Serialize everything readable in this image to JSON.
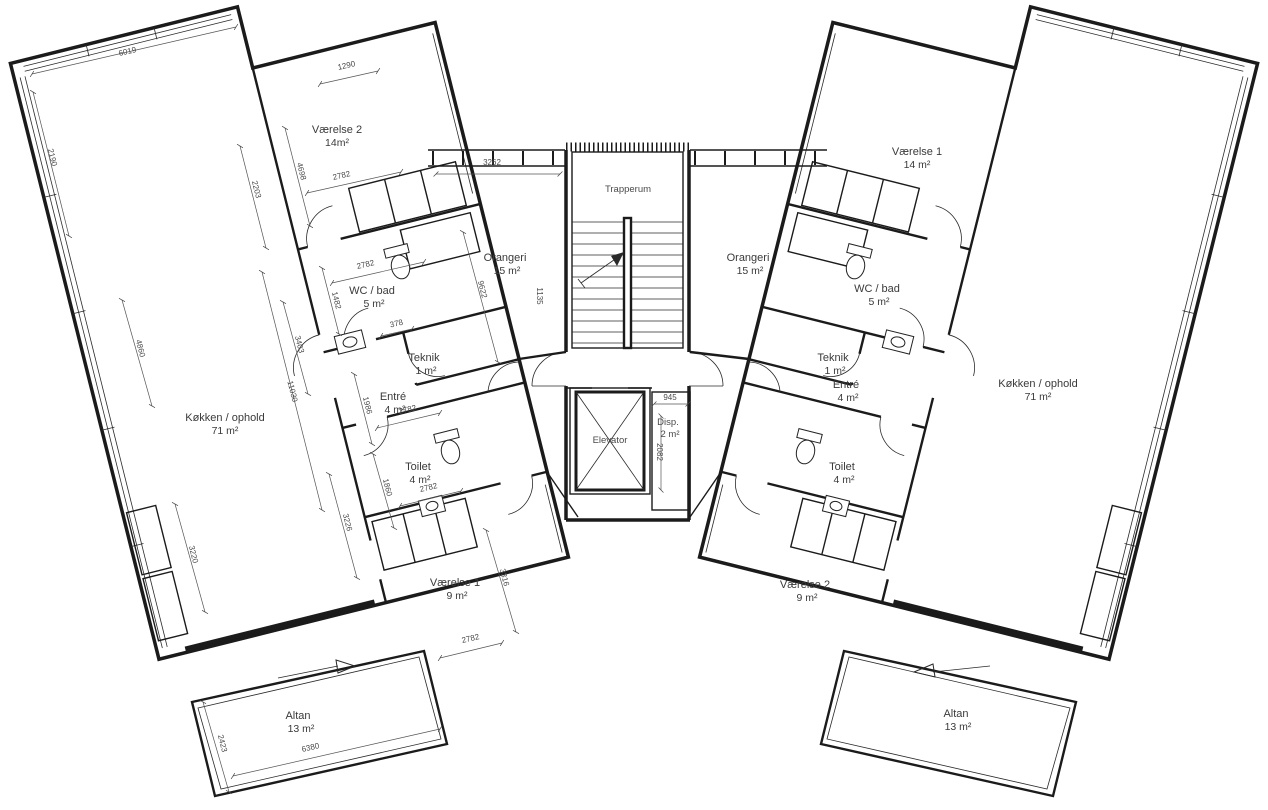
{
  "plan": {
    "core": {
      "stair": {
        "name": "Trapperum"
      },
      "elevator": {
        "name": "Elevator"
      },
      "disp": {
        "name": "Disp.",
        "area": "2 m²"
      }
    },
    "left": {
      "vaerelse2": {
        "name": "Værelse 2",
        "area": "14m²"
      },
      "wcbad": {
        "name": "WC / bad",
        "area": "5 m²"
      },
      "teknik": {
        "name": "Teknik",
        "area": "1 m²"
      },
      "entre": {
        "name": "Entré",
        "area": "4 m²"
      },
      "toilet": {
        "name": "Toilet",
        "area": "4 m²"
      },
      "kokken": {
        "name": "Køkken / ophold",
        "area": "71 m²"
      },
      "vaerelse1": {
        "name": "Værelse 1",
        "area": "9 m²"
      },
      "orangeri": {
        "name": "Orangeri",
        "area": "15 m²"
      },
      "altan": {
        "name": "Altan",
        "area": "13 m²"
      }
    },
    "right": {
      "vaerelse1": {
        "name": "Værelse 1",
        "area": "14 m²"
      },
      "wcbad": {
        "name": "WC / bad",
        "area": "5 m²"
      },
      "teknik": {
        "name": "Teknik",
        "area": "1 m²"
      },
      "entre": {
        "name": "Entré",
        "area": "4 m²"
      },
      "toilet": {
        "name": "Toilet",
        "area": "4 m²"
      },
      "orangeri": {
        "name": "Orangeri",
        "area": "15 m²"
      },
      "kokken": {
        "name": "Køkken / ophold",
        "area": "71 m²"
      },
      "vaerelse2": {
        "name": "Værelse 2",
        "area": "9 m²"
      },
      "altan": {
        "name": "Altan",
        "area": "13 m²"
      }
    }
  },
  "dims": [
    "6019",
    "2190",
    "2203",
    "1290",
    "4698",
    "2782",
    "3262",
    "2782",
    "1482",
    "378",
    "9622",
    "1135",
    "3403",
    "11030",
    "4860",
    "1986",
    "2782",
    "1860",
    "2782",
    "3226",
    "3220",
    "3316",
    "2782",
    "2423",
    "6380",
    "945",
    "2082"
  ],
  "colors": {
    "line": "#1b1b1b",
    "label": "#3a3a3a",
    "background": "#ffffff"
  }
}
